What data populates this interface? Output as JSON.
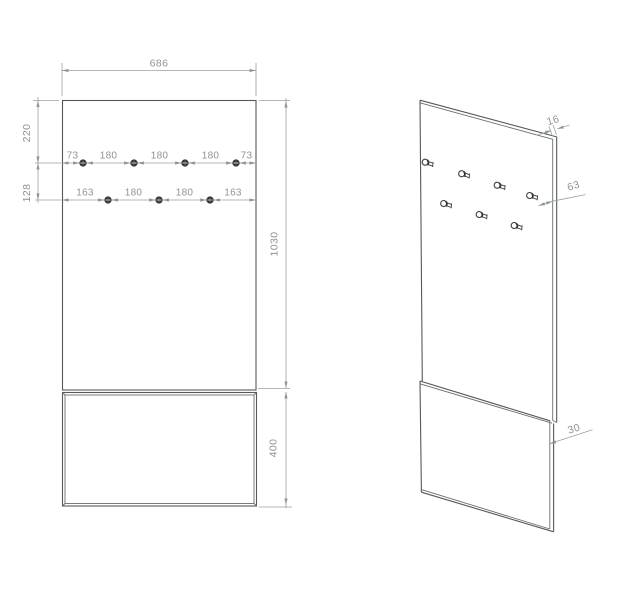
{
  "drawing_title": "wall-hanger-panel-technical-drawing",
  "views": {
    "front": {
      "label": "front-view",
      "dims": {
        "width": "686",
        "top_offset": "220",
        "row_gap": "128",
        "panel_height": "1030",
        "bottom_panel_height": "400"
      },
      "top_row_spacings": [
        "73",
        "180",
        "180",
        "180",
        "73"
      ],
      "bottom_row_spacings": [
        "163",
        "180",
        "180",
        "163"
      ],
      "hooks_top_row": 4,
      "hooks_bottom_row": 3
    },
    "iso": {
      "label": "isometric-view",
      "dims": {
        "panel_thickness": "16",
        "hook_length": "63",
        "bottom_panel_thickness": "30"
      },
      "hooks_visible": 7
    }
  },
  "colors": {
    "background": "#ffffff",
    "part_edge": "#55595c",
    "dimension_line": "#9aa0a4",
    "dimension_text": "#8f9396",
    "hook_fill": "#2f3133"
  }
}
